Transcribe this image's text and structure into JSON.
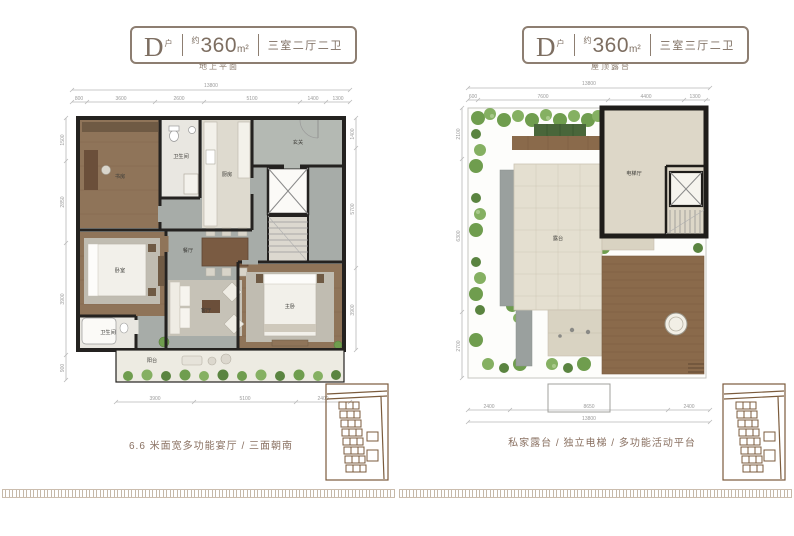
{
  "meta": {
    "accent_brown": "#8a7468",
    "wall_color": "#242220",
    "greenery": "#6f9d4e",
    "wood": "#8f7459"
  },
  "left_panel": {
    "header": {
      "type_letter": "D",
      "type_suffix": "户",
      "area_prefix": "约",
      "area_value": "360",
      "area_unit": "m²",
      "layout": "三室二厅二卫"
    },
    "floor_label": "地上平面",
    "caption": "6.6 米面宽多功能宴厅 / 三面朝南",
    "rooms": {
      "study": "书房",
      "bath1": "卫生间",
      "kitchen": "厨房",
      "foyer": "玄关",
      "dining": "餐厅",
      "living": "客厅",
      "bedroom": "卧室",
      "bath2": "卫生间",
      "master": "主卧",
      "balcony": "阳台"
    },
    "dims": {
      "top_total": "13800",
      "top_segments": [
        "800",
        "3600",
        "2600",
        "5100",
        "1400",
        "1300"
      ],
      "left_segments": [
        "1500",
        "2850",
        "3900",
        "900"
      ],
      "right_segments": [
        "1400",
        "5700",
        "3900"
      ],
      "bottom_segments": [
        "3900",
        "5100",
        "2400"
      ]
    }
  },
  "right_panel": {
    "header": {
      "type_letter": "D",
      "type_suffix": "户",
      "area_prefix": "约",
      "area_value": "360",
      "area_unit": "m²",
      "layout": "三室三厅二卫"
    },
    "floor_label": "屋顶露台",
    "caption": "私家露台 / 独立电梯 / 多功能活动平台",
    "rooms": {
      "terrace": "露台",
      "stair_hall": "电梯厅"
    },
    "dims": {
      "top_total": "13800",
      "top_segments": [
        "600",
        "7600",
        "4400",
        "1300"
      ],
      "left_segments": [
        "2100",
        "6300",
        "2700"
      ],
      "bottom_segments": [
        "2400",
        "8650",
        "2400"
      ],
      "bottom_total": "13800"
    }
  }
}
